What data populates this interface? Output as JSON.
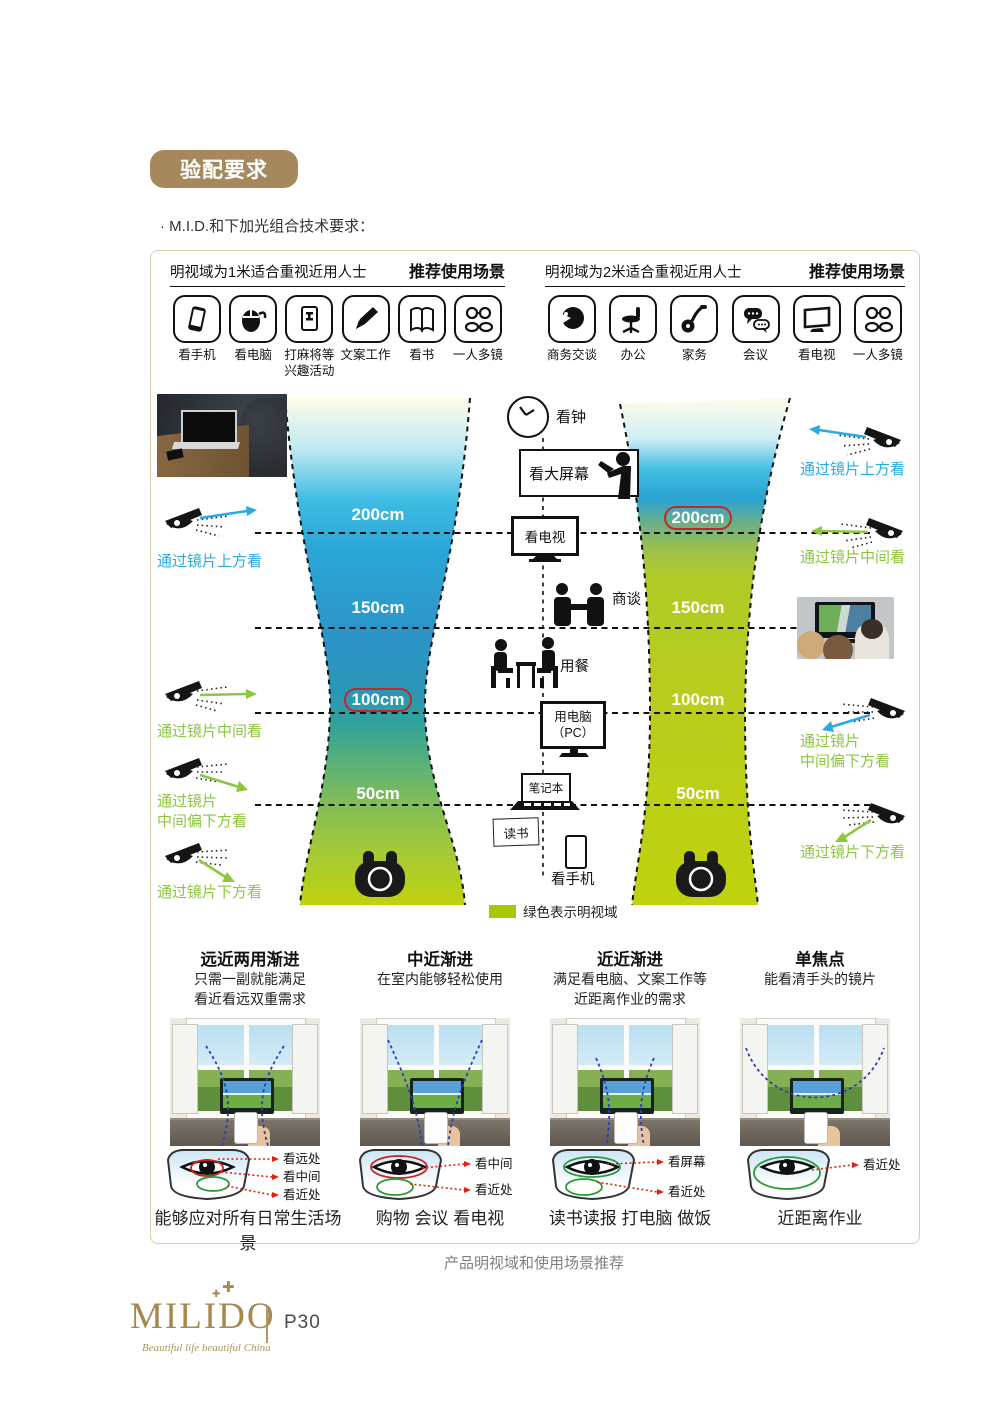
{
  "badge": "验配要求",
  "subtitle": "· M.I.D.和下加光组合技术要求：",
  "scenarios": [
    {
      "title": "明视域为1米适合重视近用人士",
      "title_bold": "推荐使用场景",
      "icons": [
        {
          "name": "phone-icon",
          "label": "看手机"
        },
        {
          "name": "mouse-icon",
          "label": "看电脑"
        },
        {
          "name": "mahjong-icon",
          "label": "打麻将等\n兴趣活动"
        },
        {
          "name": "pen-icon",
          "label": "文案工作"
        },
        {
          "name": "book-icon",
          "label": "看书"
        },
        {
          "name": "multi-glasses-icon",
          "label": "一人多镜"
        }
      ]
    },
    {
      "title": "明视域为2米适合重视近用人士",
      "title_bold": "推荐使用场景",
      "icons": [
        {
          "name": "profile-icon",
          "label": "商务交谈"
        },
        {
          "name": "office-chair-icon",
          "label": "办公"
        },
        {
          "name": "vacuum-icon",
          "label": "家务"
        },
        {
          "name": "chat-bubbles-icon",
          "label": "会议"
        },
        {
          "name": "tv-icon",
          "label": "看电视"
        },
        {
          "name": "multi-glasses-icon",
          "label": "一人多镜"
        }
      ]
    }
  ],
  "diagram": {
    "left_scale": [
      {
        "value": "200cm",
        "circled": false
      },
      {
        "value": "150cm",
        "circled": false
      },
      {
        "value": "100cm",
        "circled": true
      },
      {
        "value": "50cm",
        "circled": false
      }
    ],
    "right_scale": [
      {
        "value": "200cm",
        "circled": true
      },
      {
        "value": "150cm",
        "circled": false
      },
      {
        "value": "100cm",
        "circled": false
      },
      {
        "value": "50cm",
        "circled": false
      }
    ],
    "center_items": [
      {
        "label": "看钟"
      },
      {
        "label": "看大屏幕"
      },
      {
        "label": "看电视"
      },
      {
        "label": "商谈"
      },
      {
        "label": "用餐"
      },
      {
        "label": "用电脑\n（PC）"
      },
      {
        "label": "笔记本"
      },
      {
        "label": "读书"
      },
      {
        "label": "看手机"
      }
    ],
    "left_views": [
      {
        "text": "通过镜片上方看",
        "color": "#29abe2"
      },
      {
        "text": "通过镜片中间看",
        "color": "#8dc63f"
      },
      {
        "text": "通过镜片\n中间偏下方看",
        "color": "#8dc63f"
      },
      {
        "text": "通过镜片下方看",
        "color": "#8dc63f"
      }
    ],
    "right_views": [
      {
        "text": "通过镜片上方看",
        "color": "#29abe2"
      },
      {
        "text": "通过镜片中间看",
        "color": "#8dc63f"
      },
      {
        "text": "通过镜片\n中间偏下方看",
        "color": "#8dc63f"
      },
      {
        "text": "通过镜片下方看",
        "color": "#8dc63f"
      }
    ],
    "legend": {
      "text": "绿色表示明视域",
      "color": "#aac800"
    }
  },
  "lens_types": [
    {
      "title": "远近两用渐进",
      "desc": "只需一副就能满足\n看近看远双重需求",
      "zones": [
        "看远处",
        "看中间",
        "看近处"
      ],
      "caption": "能够应对所有日常生活场景"
    },
    {
      "title": "中近渐进",
      "desc": "在室内能够轻松使用",
      "zones": [
        "看中间",
        "看近处"
      ],
      "caption": "购物 会议 看电视"
    },
    {
      "title": "近近渐进",
      "desc": "满足看电脑、文案工作等\n近距离作业的需求",
      "zones": [
        "看屏幕",
        "看近处"
      ],
      "caption": "读书读报 打电脑 做饭"
    },
    {
      "title": "单焦点",
      "desc": "能看清手头的镜片",
      "zones": [
        "看近处"
      ],
      "caption": "近距离作业"
    }
  ],
  "figure_caption": "产品明视域和使用场景推荐",
  "footer": {
    "brand": "MILIDO",
    "tagline": "Beautiful life beautiful China",
    "page_number": "P30"
  },
  "colors": {
    "gold": "#a5895c",
    "cyan": "#29abe2",
    "green": "#8dc63f",
    "lime": "#aac800",
    "red": "#c1272d"
  }
}
